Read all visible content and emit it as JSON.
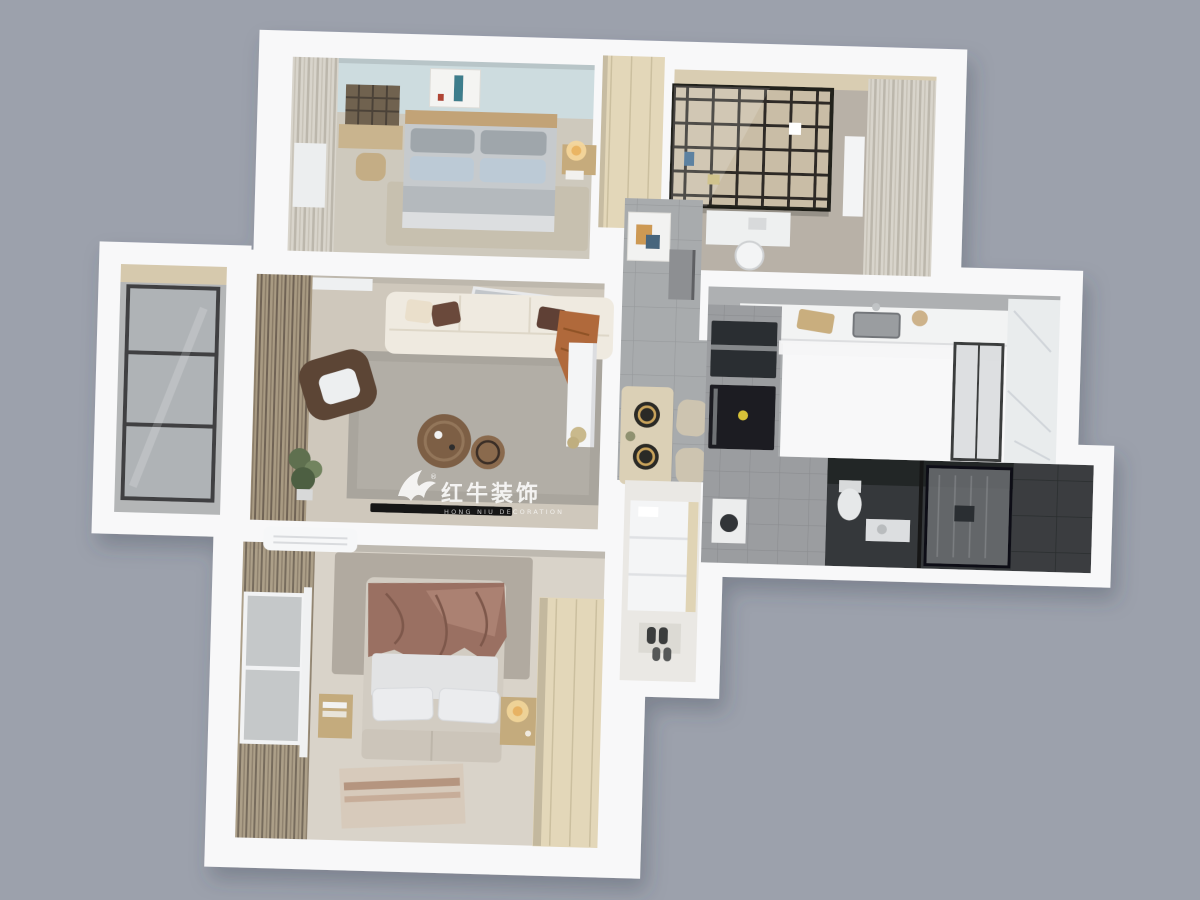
{
  "watermark": {
    "brand_cn": "红牛装饰",
    "brand_en": "HONG NIU DECORATION",
    "registered": "®",
    "color": "rgba(255,255,255,0.85)",
    "color_sub": "rgba(255,255,255,0.7)"
  },
  "scene": {
    "background": "#9ca1ac",
    "wall": "#f8f8f9",
    "wall_shadow": "#dfe0e5",
    "view": "3D top-down apartment floor plan render"
  },
  "rooms": [
    {
      "id": "bedroom-secondary",
      "label": "secondary bedroom",
      "floor": "#cec9bd",
      "accent_wall": "#cddcdf",
      "bed": "#c6cacd",
      "pillow_blue": "#bccad6"
    },
    {
      "id": "study",
      "label": "study with bookshelf",
      "floor": "#b8b1a7",
      "shelf_frame": "#22201d"
    },
    {
      "id": "balcony",
      "label": "glazed balcony",
      "floor": "#b4b6b7",
      "glass_frame": "#3f4143"
    },
    {
      "id": "living-room",
      "label": "living room",
      "floor": "#cfc8bc",
      "rug": "#a9a59d",
      "sofa": "#efeae0",
      "throw": "#b0693a",
      "armchair": "#5c4435"
    },
    {
      "id": "hallway-dining",
      "label": "entry hall and dining",
      "floor": "#a8abad"
    },
    {
      "id": "kitchen",
      "label": "kitchen",
      "counter": "#f2f3f3",
      "appliance": "#1c1e20"
    },
    {
      "id": "bathroom",
      "label": "bathroom with shower",
      "floor": "#36383a"
    },
    {
      "id": "master-bedroom",
      "label": "master bedroom",
      "floor": "#d9d3c9",
      "blanket": "#9a7062",
      "wardrobe": "#e3d7b9"
    },
    {
      "id": "corridor",
      "label": "bedroom corridor",
      "floor": "#eae8e4"
    }
  ]
}
